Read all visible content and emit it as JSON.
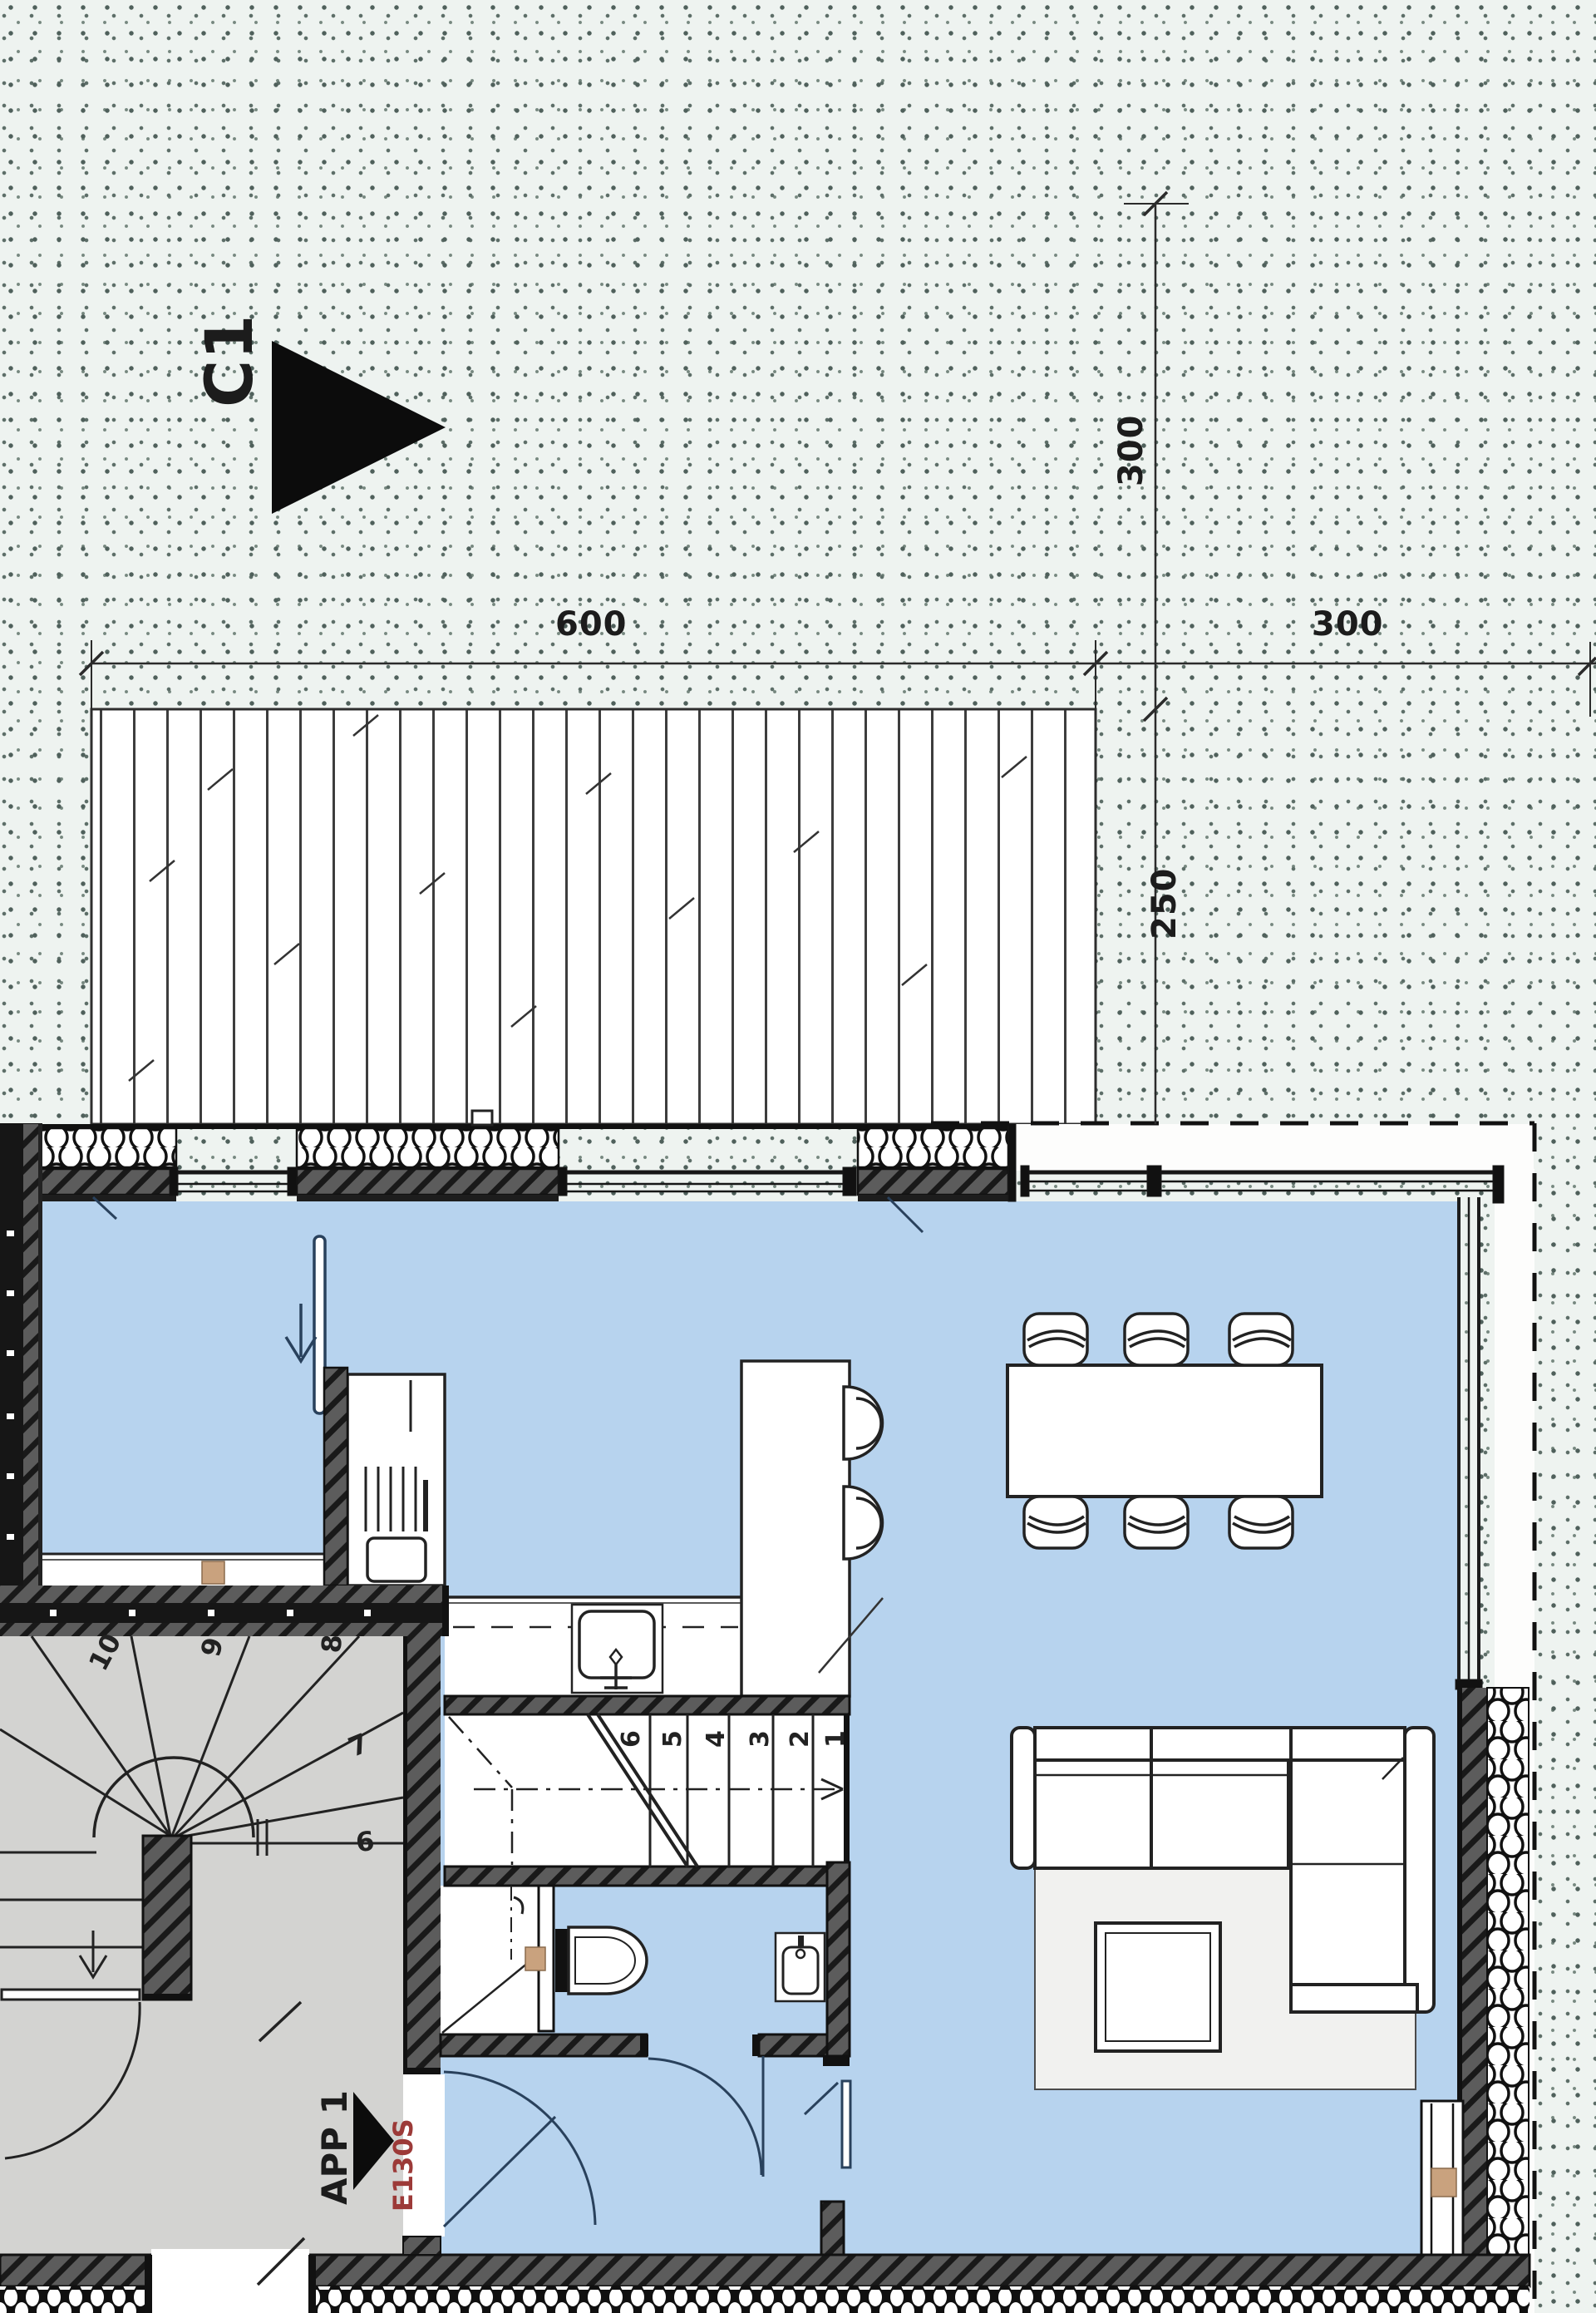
{
  "drawing": {
    "type": "architectural floor plan",
    "section_marker": {
      "label": "C1",
      "icon": "section-cut-arrow-icon",
      "direction": "right"
    },
    "apartment": {
      "name": "APP 1",
      "entry_door_code": "E130S",
      "entry_icon": "entry-arrow-icon"
    }
  },
  "dimensions": {
    "top_width_left": "600",
    "top_width_right": "300",
    "side_height_top": "300",
    "side_height_bottom": "250"
  },
  "stairs": {
    "run": [
      "1",
      "2",
      "3",
      "4",
      "5",
      "6"
    ],
    "winder": [
      "6",
      "7",
      "8",
      "9",
      "10"
    ],
    "direction_icons": [
      "arrow-down-icon",
      "arrow-right-icon"
    ]
  },
  "kitchen": {
    "fixtures": [
      "tall-cabinet",
      "oven-grill",
      "counter",
      "sink-icon",
      "island",
      "bar-stool",
      "bar-stool"
    ],
    "wall_cabinet_line": "dashed"
  },
  "bathroom": {
    "fixtures": [
      "shower",
      "shower-head-icon",
      "toilet-icon",
      "washbasin-icon"
    ],
    "doors": [
      "bathroom-door",
      "hall-door"
    ]
  },
  "furniture": {
    "dining": {
      "table": "dining-table",
      "chairs": 6
    },
    "living": {
      "sofa": "corner-sofa",
      "rug": "rug",
      "coffee_table": "coffee-table"
    }
  },
  "site": {
    "deck": "wood-deck-terrace",
    "ground": "stippled-ground",
    "roof_overhang_line": "dashed",
    "insulation": "batt-hatch"
  },
  "colors": {
    "interior_floor": "#b7d3ee",
    "stairwell_floor": "#d3d3d1",
    "wall_hatch": "#5c5c5c",
    "wood_block": "#c9a27e",
    "door_code_red": "#9c3a38",
    "ground_tint": "#eef3f0",
    "line": "#1c1c1c"
  }
}
